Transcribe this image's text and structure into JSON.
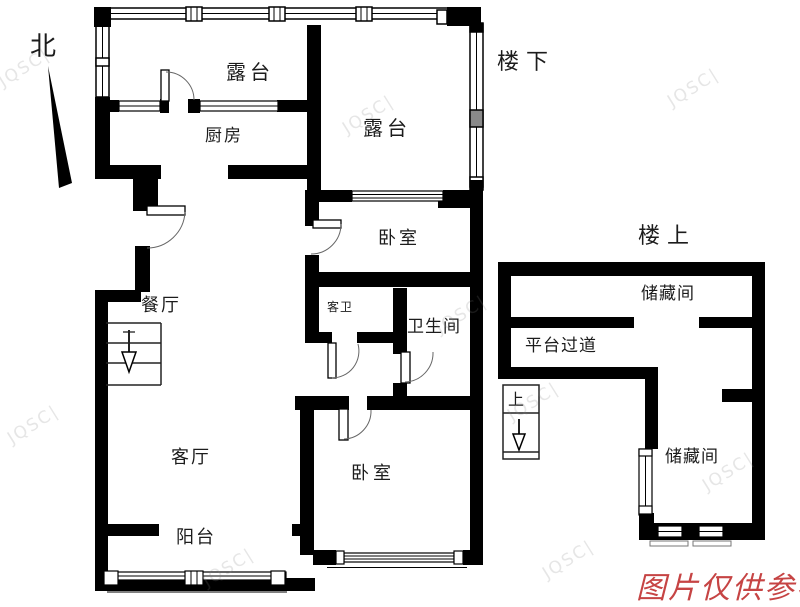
{
  "plan": {
    "compass": {
      "north_label": "北"
    },
    "level_labels": {
      "downstairs": "楼下",
      "upstairs": "楼上"
    },
    "rooms": {
      "terrace_top": "露台",
      "terrace_right": "露台",
      "kitchen": "厨房",
      "bedroom_upper": "卧室",
      "guest_bath": "客卫",
      "bathroom": "卫生间",
      "dining": "餐厅",
      "living": "客厅",
      "balcony": "阳台",
      "bedroom_lower": "卧室",
      "storage_upper": "储藏间",
      "corridor": "平台过道",
      "storage_lower": "储藏间"
    },
    "stairs": {
      "up_label": "上"
    },
    "disclaimer": {
      "text": "图片仅供参考",
      "color": "#c64444"
    },
    "watermark": {
      "text": "JQSC|"
    },
    "colors": {
      "wall": "#000000",
      "door_arc": "#666666"
    }
  }
}
